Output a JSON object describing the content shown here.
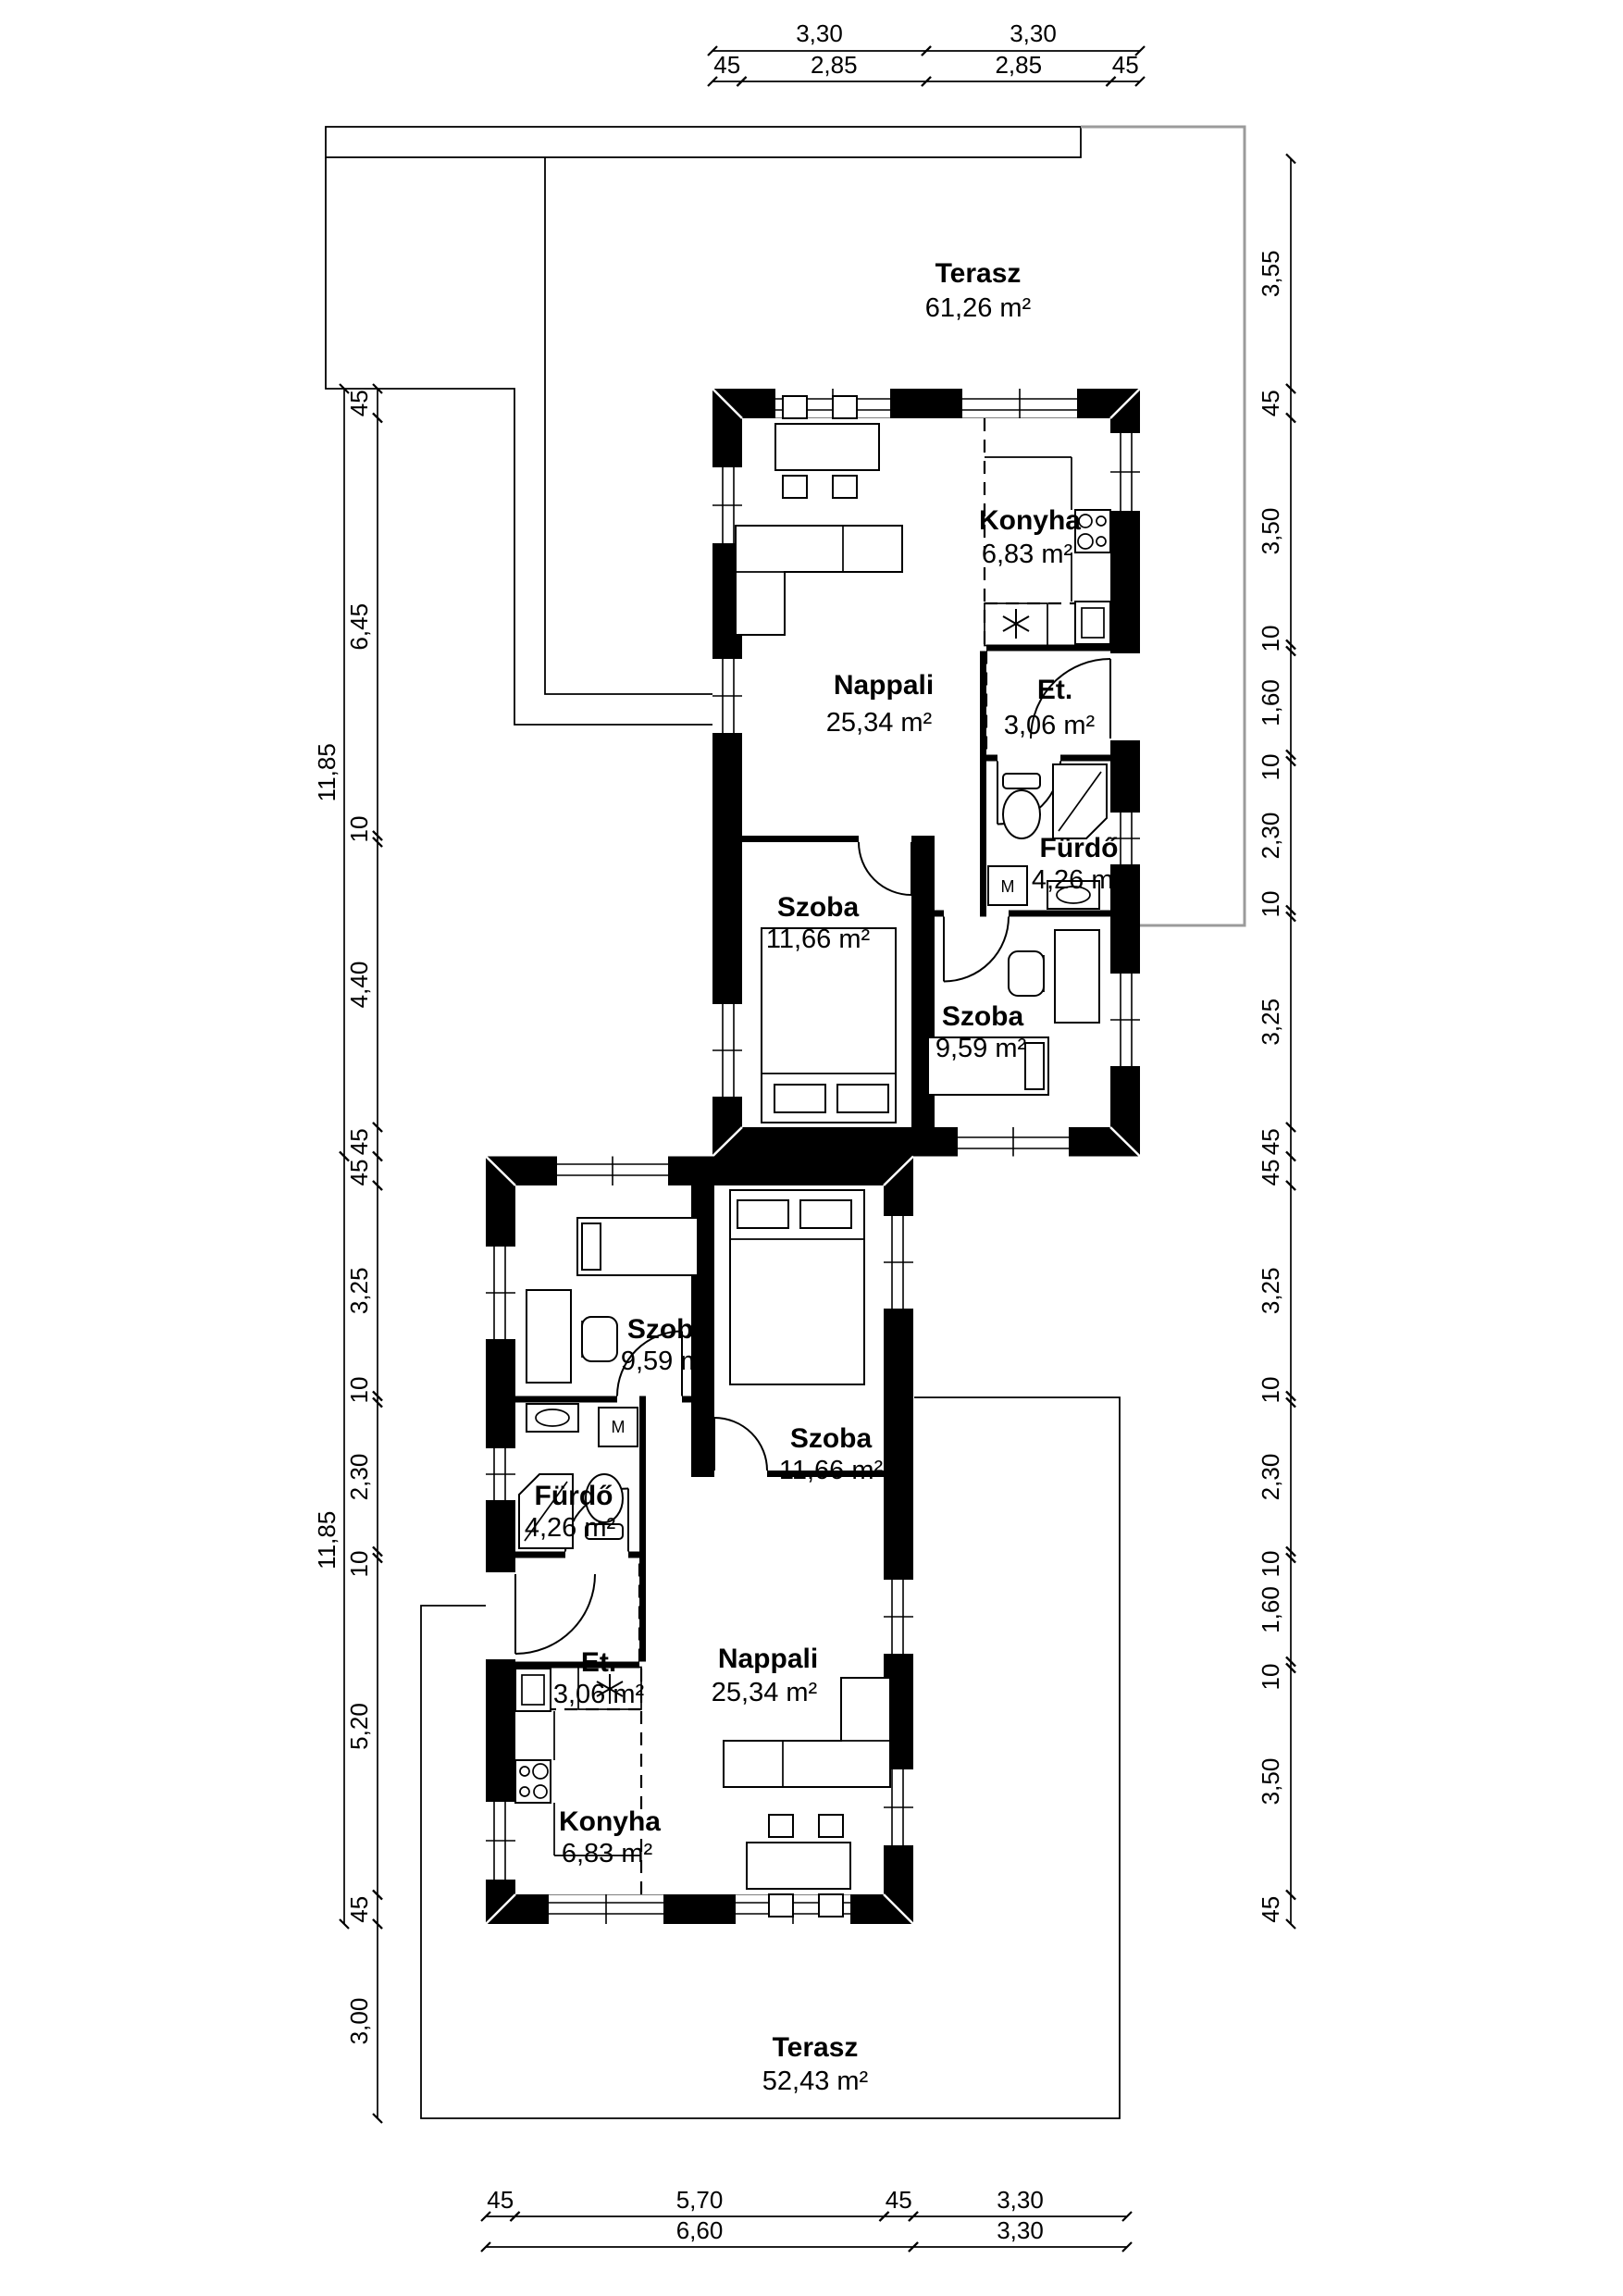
{
  "plan": {
    "terasz_top": {
      "name": "Terasz",
      "area": "61,26 m²"
    },
    "terasz_bottom": {
      "name": "Terasz",
      "area": "52,43 m²"
    },
    "upper": {
      "konyha": {
        "name": "Konyha",
        "area": "6,83 m²"
      },
      "nappali": {
        "name": "Nappali",
        "area": "25,34 m²"
      },
      "et": {
        "name": "Et.",
        "area": "3,06 m²"
      },
      "furdo": {
        "name": "Fürdő",
        "area": "4,26 m²"
      },
      "szoba_nagy": {
        "name": "Szoba",
        "area": "11,66 m²"
      },
      "szoba_kis": {
        "name": "Szoba",
        "area": "9,59 m²"
      }
    },
    "lower": {
      "konyha": {
        "name": "Konyha",
        "area": "6,83 m²"
      },
      "nappali": {
        "name": "Nappali",
        "area": "25,34 m²"
      },
      "et": {
        "name": "Et.",
        "area": "3,06 m²"
      },
      "furdo": {
        "name": "Fürdő",
        "area": "4,26 m²"
      },
      "szoba_nagy": {
        "name": "Szoba",
        "area": "11,66 m²"
      },
      "szoba_kis": {
        "name": "Szoba",
        "area": "9,59 m²"
      }
    },
    "fixtures": {
      "washing_machine": "M"
    },
    "dims": {
      "top": {
        "row1": [
          "3,30",
          "3,30"
        ],
        "row2": [
          "45",
          "2,85",
          "2,85",
          "45"
        ]
      },
      "bottom": {
        "row1": [
          "45",
          "5,70",
          "45",
          "3,30"
        ],
        "row2": [
          "6,60",
          "3,30"
        ]
      },
      "left": {
        "total_upper": "11,85",
        "total_lower": "11,85",
        "upper": [
          "45",
          "6,45",
          "10",
          "4,40",
          "45"
        ],
        "lower": [
          "45",
          "3,25",
          "10",
          "2,30",
          "10",
          "5,20",
          "45"
        ],
        "terrace": "3,00"
      },
      "right": {
        "terrace": "3,55",
        "upper": [
          "45",
          "3,50",
          "10",
          "1,60",
          "10",
          "2,30",
          "10",
          "3,25",
          "45"
        ],
        "lower": [
          "45",
          "3,25",
          "10",
          "2,30",
          "10",
          "1,60",
          "10",
          "3,50",
          "45"
        ]
      }
    }
  }
}
